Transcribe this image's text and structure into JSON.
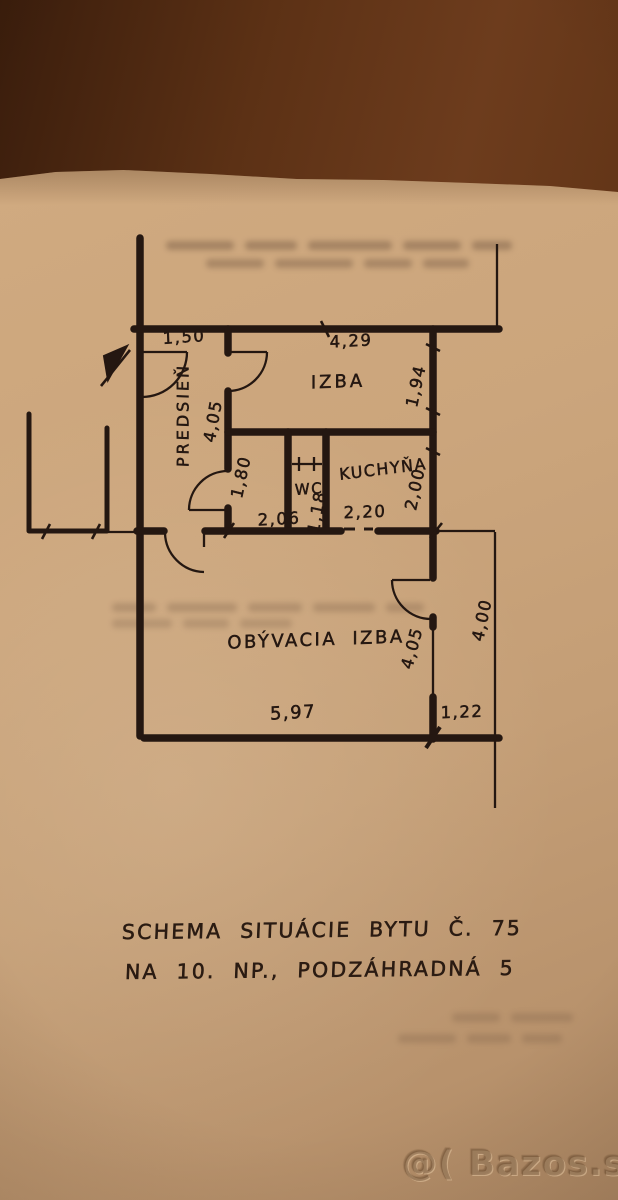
{
  "plan": {
    "rooms": {
      "predsien": "PREDSIEŇ",
      "izba": "IZBA",
      "wc": "WC",
      "kuchyna": "KUCHYŇA",
      "obyvacia_izba": "OBÝVACIA IZBA"
    },
    "dimensions": {
      "entry_width": "1,50",
      "izba_width": "4,29",
      "izba_depth": "1,94",
      "hall_length": "4,05",
      "hall_width": "1,80",
      "kitchen_depth": "2,00",
      "hall_bottom": "2,06",
      "wc_width": "1,18",
      "kitchen_opening": "2,20",
      "living_depth": "4,05",
      "right_side": "4,00",
      "living_width": "5,97",
      "right_bottom": "1,22"
    }
  },
  "caption": {
    "line1": "SCHEMA SITUÁCIE BYTU Č. 75",
    "line2": "NA 10. NP., PODZÁHRADNÁ 5"
  },
  "watermark": {
    "text": "@( Bazos.sk"
  },
  "colors": {
    "table_background": "#5e3318",
    "paper": "#c9a47c",
    "ink": "#241711",
    "watermark": "#8a6647"
  }
}
